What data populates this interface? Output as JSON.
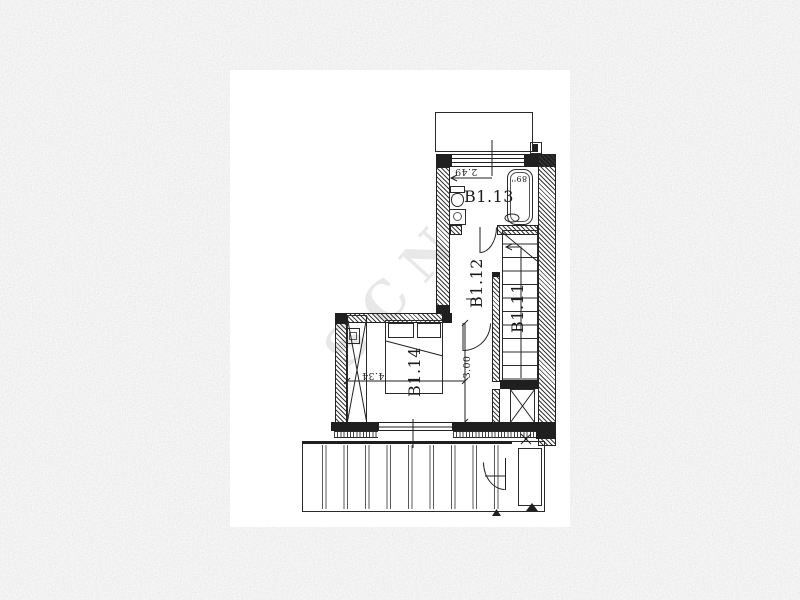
{
  "floor_plan": {
    "room_labels": {
      "bathroom": "B1.13",
      "hallway": "B1.12",
      "stairs": "B1.11",
      "bedroom": "B1.14"
    },
    "dimensions": {
      "bathroom_width": "2.49",
      "bedroom_depth": "3.00",
      "bedroom_width": "4.34",
      "bathtub_size": "89''"
    },
    "watermark": "SCN",
    "colors": {
      "paper": "#ffffff",
      "ink": "#1f1f1f",
      "background_base": "#d8d8d8",
      "watermark_ink": "rgba(90,90,90,0.14)"
    }
  }
}
